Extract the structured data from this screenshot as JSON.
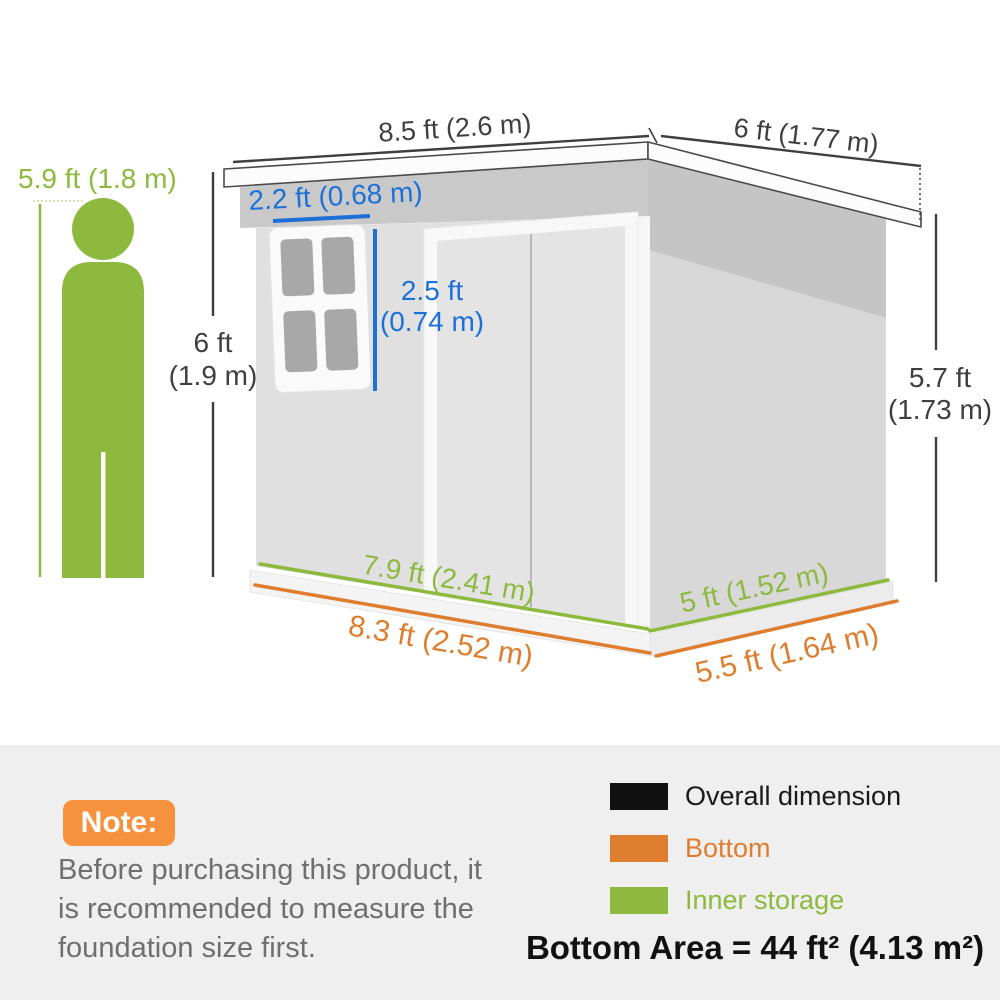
{
  "colors": {
    "green": "#8CB93E",
    "green_light": "#CBDC9A",
    "blue": "#1D70D8",
    "orange": "#DF7D2E",
    "note_orange": "#F6923E",
    "dim_dark": "#3F3F3F",
    "note_gray": "#6F6F6F",
    "panel_bg": "#F0EFEF",
    "legend_black": "#111111"
  },
  "diagram": {
    "person_height": "5.9 ft (1.8 m)",
    "roof_width": "8.5 ft (2.6 m)",
    "roof_depth": "6 ft (1.77 m)",
    "window_width": "2.2 ft (0.68 m)",
    "window_height": [
      "2.5 ft",
      "(0.74 m)"
    ],
    "front_height": [
      "6 ft",
      "(1.9 m)"
    ],
    "rear_height": [
      "5.7 ft",
      "(1.73 m)"
    ],
    "inner_storage_front": "7.9 ft (2.41 m)",
    "inner_storage_side": "5 ft (1.52 m)",
    "bottom_front": "8.3 ft (2.52 m)",
    "bottom_side": "5.5 ft (1.64 m)"
  },
  "note": {
    "badge": "Note:",
    "lines": [
      "Before purchasing this product, it",
      "is recommended to measure the",
      "foundation size first."
    ]
  },
  "legend": {
    "items": [
      {
        "label": "Overall dimension",
        "color": "#111111"
      },
      {
        "label": "Bottom",
        "color": "#DF7D2E"
      },
      {
        "label": "Inner storage",
        "color": "#8CB93E"
      }
    ],
    "bottom_area": "Bottom Area = 44 ft² (4.13 m²)"
  }
}
